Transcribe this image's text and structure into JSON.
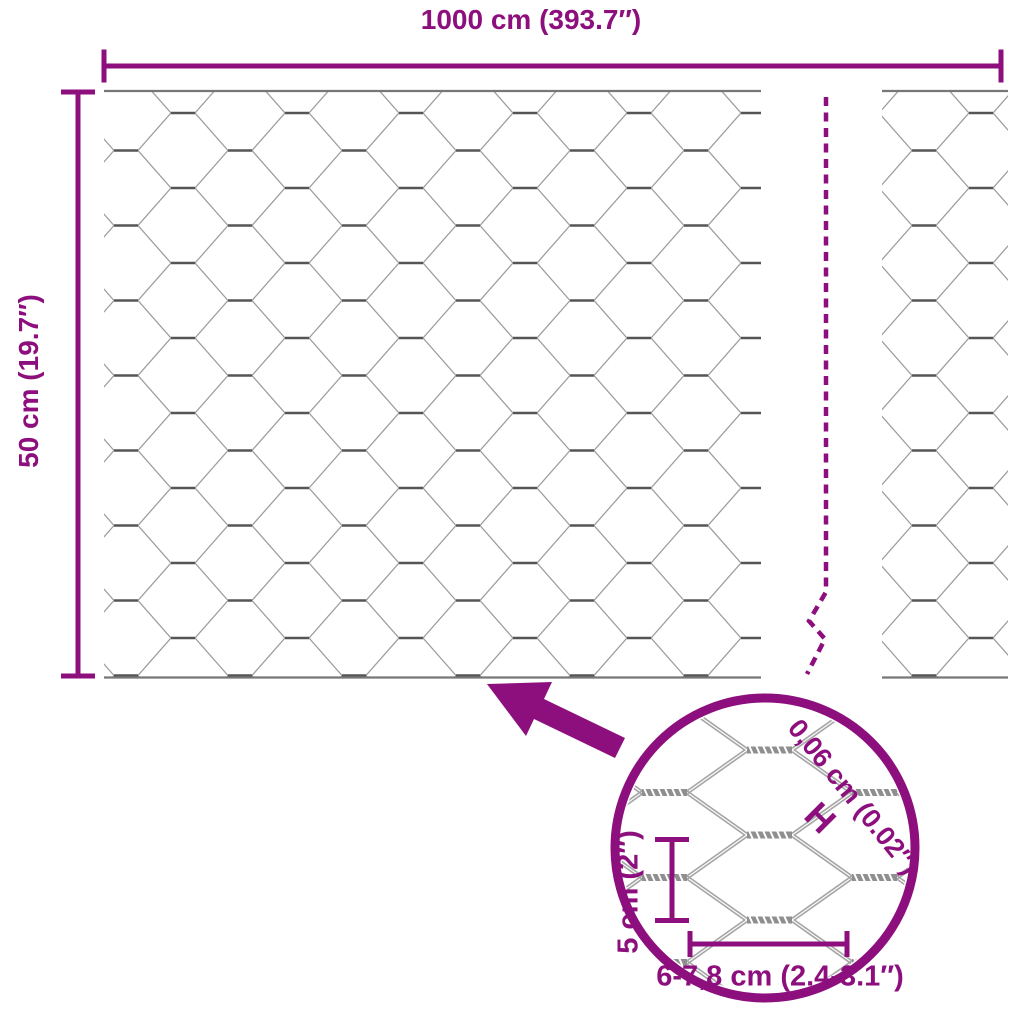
{
  "product": "hexagonal-wire-mesh-dimension-diagram",
  "colors": {
    "accent": "#8d0f7e",
    "wire": "#9c9c9c",
    "wire_dark": "#555555",
    "edge": "#777777",
    "detail_wire": "#a6a6a6",
    "twist": "#8f8f8f"
  },
  "labels": {
    "roll_width": "1000 cm (393.7″)",
    "roll_height": "50 cm (19.7″)",
    "wire_thickness": "0,06 cm (0.02″)",
    "wire_thickness_marker": "H",
    "cell_height": "5 cm (2″)",
    "cell_width": "6-7,8 cm (2.4-3.1″)"
  }
}
